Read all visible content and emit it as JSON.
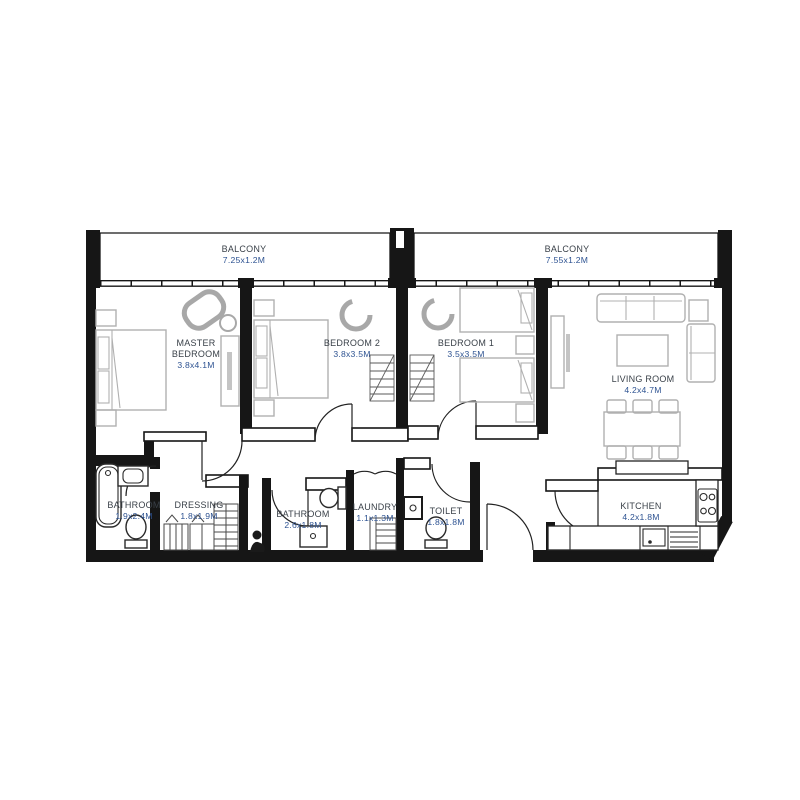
{
  "colors": {
    "wall": "#161616",
    "furniture_outline": "#b0b0b0",
    "fixture_outline": "#2a2a2a",
    "room_label": "#3a4149",
    "dimension_label": "#2d5291",
    "background": "#ffffff"
  },
  "balconies": {
    "left": {
      "name": "BALCONY",
      "dims": "7.25x1.2M"
    },
    "right": {
      "name": "BALCONY",
      "dims": "7.55x1.2M"
    }
  },
  "rooms": {
    "master_bedroom": {
      "line1": "MASTER",
      "line2": "BEDROOM",
      "dims": "3.8x4.1M"
    },
    "bedroom2": {
      "name": "BEDROOM 2",
      "dims": "3.8x3.5M"
    },
    "bedroom1": {
      "name": "BEDROOM 1",
      "dims": "3.5x3.5M"
    },
    "living_room": {
      "name": "LIVING ROOM",
      "dims": "4.2x4.7M"
    },
    "bathroom_master": {
      "name": "BATHROOM",
      "dims": "1.9x2.4M"
    },
    "dressing": {
      "name": "DRESSING",
      "dims": "1.8x1.9M"
    },
    "bathroom2": {
      "name": "BATHROOM",
      "dims": "2.6x1.8M"
    },
    "laundry": {
      "name": "LAUNDRY",
      "dims": "1.1x1.3M"
    },
    "toilet": {
      "name": "TOILET",
      "dims": "1.8x1.8M"
    },
    "kitchen": {
      "name": "KITCHEN",
      "dims": "4.2x1.8M"
    }
  }
}
